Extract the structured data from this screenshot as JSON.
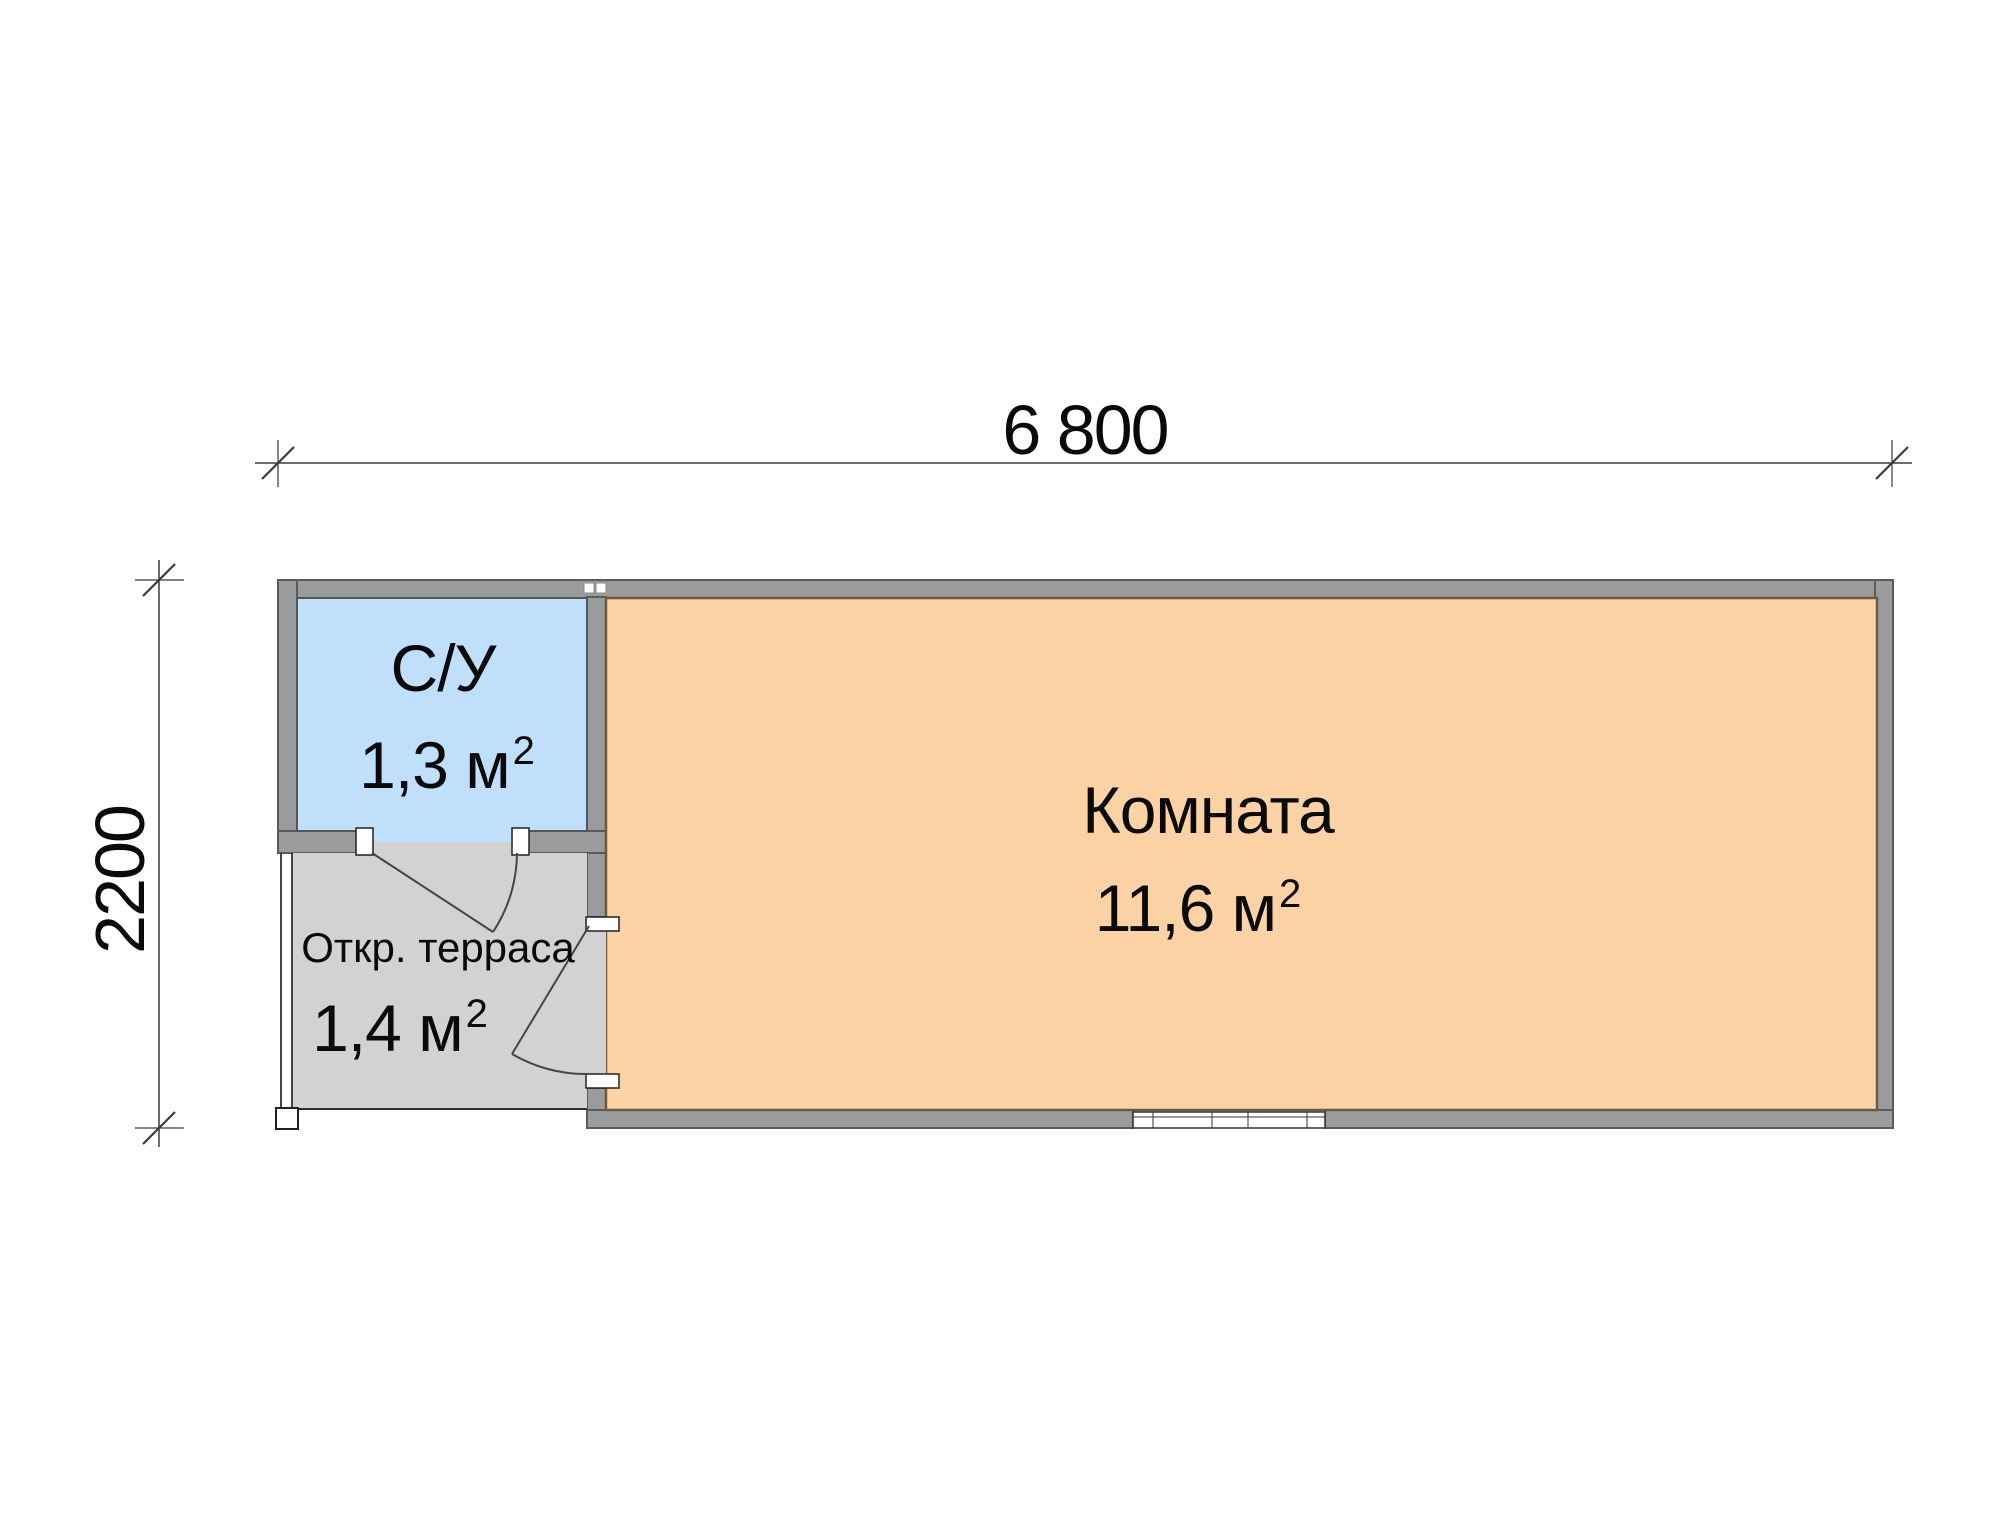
{
  "document": {
    "type": "floor-plan"
  },
  "colors": {
    "bg": "#ffffff",
    "wall_fill": "#9a9b9d",
    "wall_stroke": "#5b5b5b",
    "bathroom_fill": "#bfdffb",
    "bathroom_stroke": "#53575b",
    "room_fill": "#fbd2a3",
    "room_stroke": "#6e5a3e",
    "terrace_fill": "#d2d2d2",
    "edge_line": "#2f2f2f",
    "dim_line": "#3a3a3a",
    "door_line": "#454545",
    "text": "#0a0a0a"
  },
  "dimensions": {
    "width_label": "6 800",
    "height_label": "2200"
  },
  "rooms": {
    "bathroom": {
      "name": "С/У",
      "area_value": "1,3 м",
      "area_sup": "2"
    },
    "terrace": {
      "name": "Откр. терраса",
      "area_value": "1,4 м",
      "area_sup": "2"
    },
    "room": {
      "name": "Комната",
      "area_value": "11,6 м",
      "area_sup": "2"
    }
  }
}
